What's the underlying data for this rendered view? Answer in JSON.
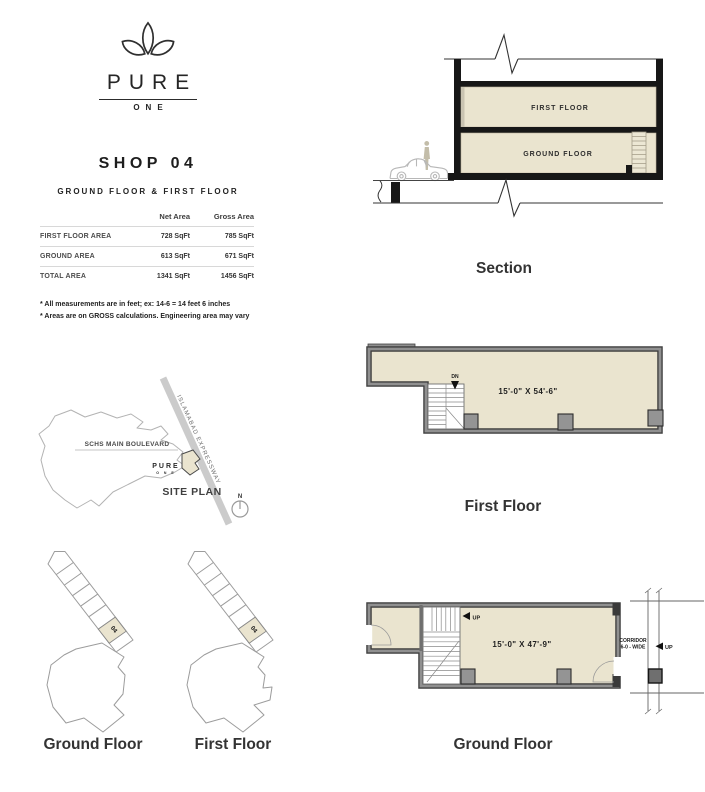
{
  "colors": {
    "beige": "#EAE4CF",
    "wall_dark": "#3F3F3F",
    "wall_gray": "#909090",
    "slab_black": "#171717",
    "light_line": "#B3B3B3",
    "ink": "#333333"
  },
  "brand": {
    "name": "PURE",
    "sub": "ONE"
  },
  "shop": {
    "title": "SHOP 04",
    "subtitle": "GROUND FLOOR & FIRST FLOOR"
  },
  "area_table": {
    "col_net": "Net Area",
    "col_gross": "Gross Area",
    "rows": [
      {
        "label": "FIRST FLOOR AREA",
        "net": "728 SqFt",
        "gross": "785 SqFt"
      },
      {
        "label": "GROUND AREA",
        "net": "613 SqFt",
        "gross": "671 SqFt"
      },
      {
        "label": "TOTAL AREA",
        "net": "1341 SqFt",
        "gross": "1456 SqFt"
      }
    ]
  },
  "notes": {
    "line1": "* All measurements are in feet; ex: 14-6 = 14 feet 6 inches",
    "line2": "* Areas are on GROSS calculations. Engineering area may vary"
  },
  "site_plan": {
    "boulevard": "SCHS MAIN BOULEVARD",
    "expressway": "ISLAMABAD EXPRESSWAY",
    "brand": "PURE",
    "brand_sub": "O N E",
    "label": "SITE PLAN",
    "north": "N"
  },
  "section": {
    "first_floor": "FIRST FLOOR",
    "ground_floor": "GROUND FLOOR",
    "label": "Section"
  },
  "first_floor_plan": {
    "dimension": "15'-0\" X 54'-6\"",
    "stair_dir": "DN",
    "label": "First Floor"
  },
  "ground_floor_plan": {
    "dimension": "15'-0\" X 47'-9\"",
    "stair_dir": "UP",
    "corridor_line1": "CORRIDOR",
    "corridor_line2": "6-0 - WIDE",
    "corridor_up": "UP",
    "label": "Ground Floor"
  },
  "key_plans": {
    "unit_ground": "04",
    "unit_first": "04",
    "ground_label": "Ground Floor",
    "first_label": "First Floor"
  }
}
